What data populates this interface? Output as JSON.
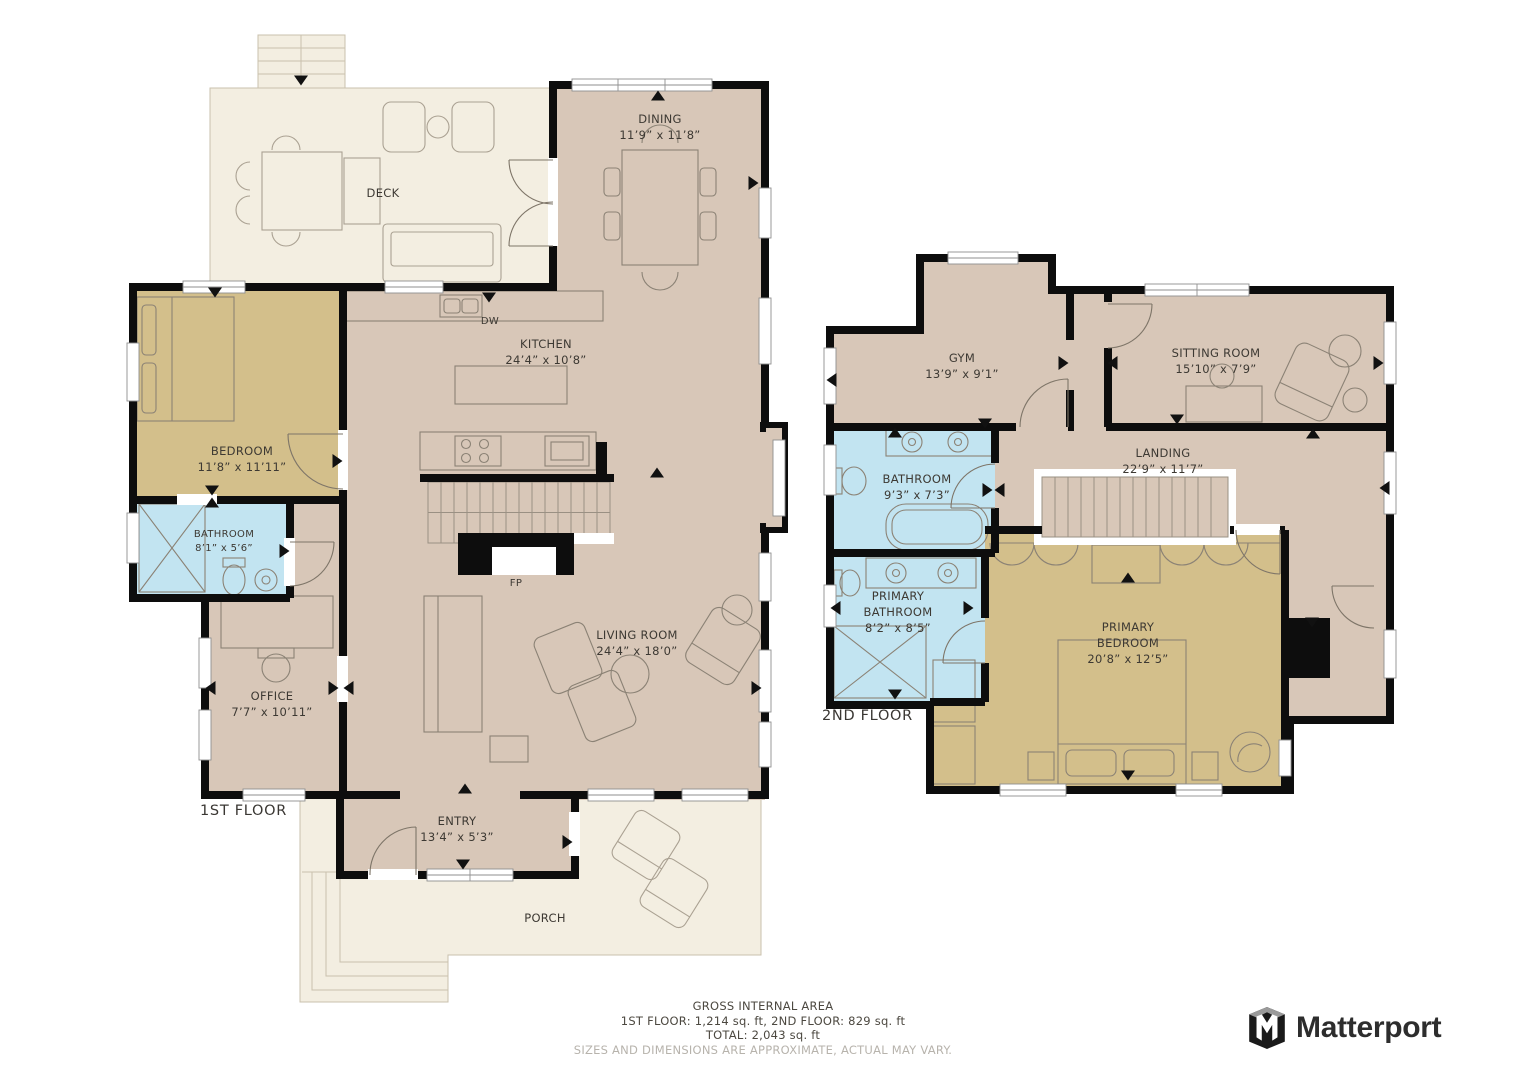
{
  "colors": {
    "room_tan": "#d8c7b8",
    "bedroom_khaki": "#d3bf8b",
    "bathroom_blue": "#c2e4f1",
    "outdoor_cream": "#f3eee1",
    "wall_black": "#0d0d0d"
  },
  "floor1": {
    "label": "1ST FLOOR",
    "rooms": {
      "deck": {
        "name": "DECK"
      },
      "dining": {
        "name": "DINING",
        "dims": "11’9” x 11’8”"
      },
      "kitchen": {
        "name": "KITCHEN",
        "dims": "24’4” x 10’8”"
      },
      "bedroom": {
        "name": "BEDROOM",
        "dims": "11’8” x 11’11”"
      },
      "bathroom": {
        "name": "BATHROOM",
        "dims": "8’1” x 5’6”"
      },
      "office": {
        "name": "OFFICE",
        "dims": "7’7” x 10’11”"
      },
      "living_room": {
        "name": "LIVING ROOM",
        "dims": "24’4” x 18’0”"
      },
      "entry": {
        "name": "ENTRY",
        "dims": "13’4” x 5’3”"
      },
      "porch": {
        "name": "PORCH"
      }
    },
    "annotations": {
      "dishwasher": "DW",
      "fireplace": "FP"
    }
  },
  "floor2": {
    "label": "2ND FLOOR",
    "rooms": {
      "gym": {
        "name": "GYM",
        "dims": "13’9” x 9’1”"
      },
      "sitting_room": {
        "name": "SITTING ROOM",
        "dims": "15’10” x 7’9”"
      },
      "landing": {
        "name": "LANDING",
        "dims": "22’9” x 11’7”"
      },
      "bathroom": {
        "name": "BATHROOM",
        "dims": "9’3” x 7’3”"
      },
      "primary_bathroom": {
        "name": "PRIMARY BATHROOM",
        "dims": "8’2” x 8’5”"
      },
      "primary_bedroom": {
        "name": "PRIMARY BEDROOM",
        "dims": "20’8” x 12’5”"
      }
    }
  },
  "footer": {
    "title": "GROSS INTERNAL AREA",
    "areas": "1ST FLOOR: 1,214 sq. ft, 2ND FLOOR: 829 sq. ft",
    "total": "TOTAL: 2,043 sq. ft",
    "disclaimer": "SIZES AND DIMENSIONS ARE APPROXIMATE, ACTUAL MAY VARY."
  },
  "brand": {
    "name": "Matterport"
  }
}
